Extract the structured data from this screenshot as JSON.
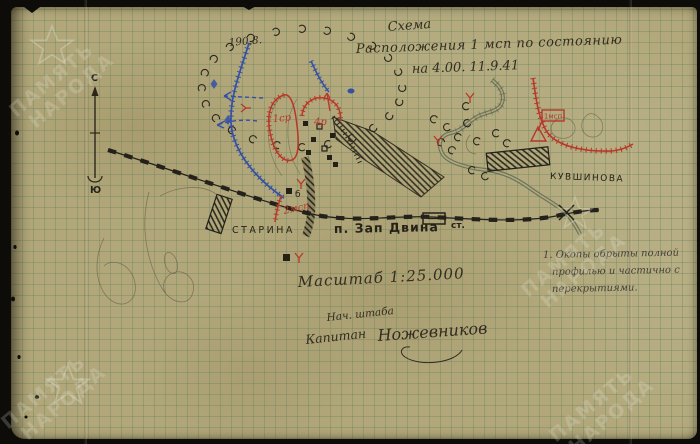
{
  "title": {
    "line1": "Схема",
    "line2": "Расположения 1 мсп по состоянию",
    "line3": "на 4.00. 11.9.41"
  },
  "compass": {
    "north": "С",
    "south": "Ю"
  },
  "terrain": {
    "elevation": "190,8."
  },
  "settlements": {
    "starina": "СТАРИНА",
    "kuvshinova": "КУВШИНОВА",
    "zap_dvina": "п. Зап Двина",
    "station_abbr": "ст.",
    "building_mark": "б"
  },
  "units": {
    "company_1": "1ср",
    "company_4": "4р",
    "regiment_cp": "1мсп",
    "regiment_2": "2мсп"
  },
  "scale_text": "Масштаб 1:25.000",
  "note": {
    "lines": [
      "1. Окопы обрыты полной",
      "профилью и частично с",
      "перекрытиями."
    ]
  },
  "signature": {
    "role": "Нач. штаба",
    "rank": "Капитан",
    "name": "Ножевников"
  },
  "watermark": {
    "line1": "ПАМЯТЬ",
    "line2": "НАРОДА"
  },
  "colors": {
    "scan_background": "#0d0c09",
    "paper": "#b1a77a",
    "grid_line": "#607e56",
    "ink_black": "#272219",
    "ink_red": "#b7382a",
    "ink_blue": "#3350a5",
    "river": "#5e6c58",
    "watermark": "#f2f0e4"
  }
}
